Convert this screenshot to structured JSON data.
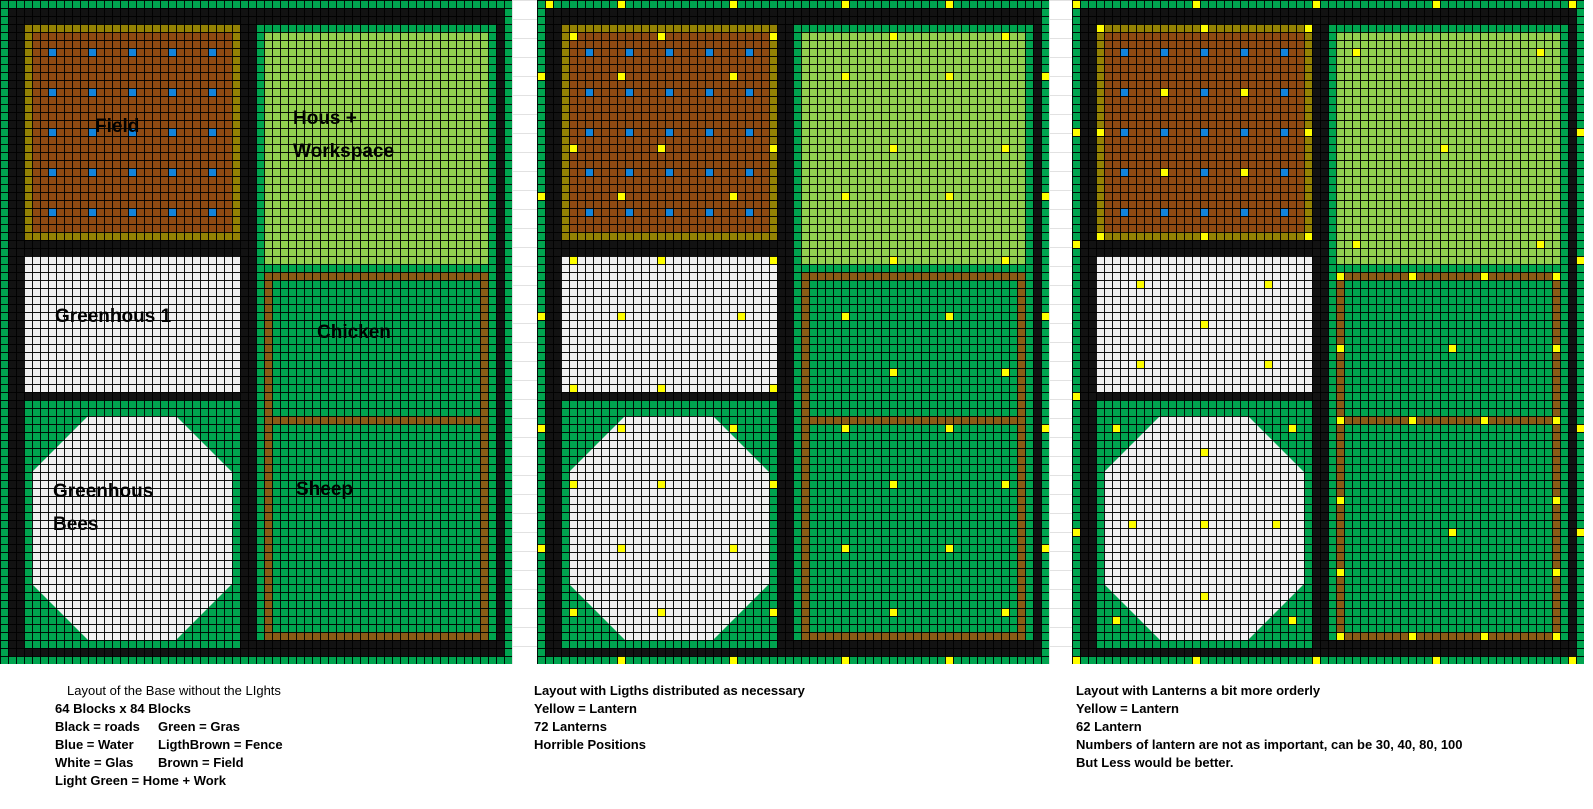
{
  "diagram_title": "Minecraft base layout plan (3 variants)",
  "grid": {
    "cell_px": 8,
    "cols": 64,
    "rows": 83,
    "octagon_cut_px": 56,
    "colors": {
      "road": "#121212",
      "grass": "#00a44f",
      "light_green": "#92d050",
      "glass_white": "#f0f0f0",
      "field_brown": "#8e4a12",
      "field_fence": "#948204",
      "pen_fence": "#8a5c16",
      "water_blue": "#1184dc",
      "lantern_yellow": "#ffff00",
      "grid_line": "#000000"
    },
    "regions": [
      {
        "name": "border-top",
        "c": 0,
        "r": 0,
        "w": 64,
        "h": 1,
        "color": "grass"
      },
      {
        "name": "border-bottom",
        "c": 0,
        "r": 82,
        "w": 64,
        "h": 1,
        "color": "grass"
      },
      {
        "name": "border-left",
        "c": 0,
        "r": 0,
        "w": 1,
        "h": 83,
        "color": "grass"
      },
      {
        "name": "border-right",
        "c": 63,
        "r": 0,
        "w": 1,
        "h": 83,
        "color": "grass"
      },
      {
        "name": "field-fence",
        "c": 3,
        "r": 3,
        "w": 27,
        "h": 27,
        "color": "field_fence"
      },
      {
        "name": "field-soil",
        "c": 4,
        "r": 4,
        "w": 25,
        "h": 25,
        "color": "field_brown"
      },
      {
        "name": "hous-grass-edge",
        "c": 32,
        "r": 3,
        "w": 30,
        "h": 31,
        "color": "grass"
      },
      {
        "name": "hous-floor",
        "c": 33,
        "r": 4,
        "w": 28,
        "h": 29,
        "color": "light_green"
      },
      {
        "name": "greenhous1-glass",
        "c": 3,
        "r": 32,
        "w": 27,
        "h": 17,
        "color": "glass_white"
      },
      {
        "name": "pen-grass",
        "c": 32,
        "r": 34,
        "w": 30,
        "h": 46,
        "color": "grass"
      },
      {
        "name": "pen-fence",
        "c": 33,
        "r": 34,
        "w": 28,
        "h": 46,
        "color": "pen_fence"
      },
      {
        "name": "pen-inner-grass",
        "c": 34,
        "r": 35,
        "w": 26,
        "h": 44,
        "color": "grass"
      },
      {
        "name": "pen-divider-fence",
        "c": 33,
        "r": 52,
        "w": 28,
        "h": 1,
        "color": "pen_fence"
      },
      {
        "name": "bees-grass",
        "c": 3,
        "r": 50,
        "w": 27,
        "h": 31,
        "color": "grass"
      },
      {
        "name": "bees-glass-octagon",
        "c": 4,
        "r": 52,
        "w": 25,
        "h": 28,
        "color": "glass_white",
        "octagon": true
      }
    ],
    "water": {
      "cols": [
        6,
        11,
        16,
        21,
        26
      ],
      "rows": [
        6,
        11,
        16,
        21,
        26
      ]
    }
  },
  "panels": [
    {
      "id": "base-without-lights",
      "title": "Layout of the Base without the LIghts",
      "caption_lines": [
        {
          "left": "64 Blocks x 84 Blocks",
          "right": ""
        },
        {
          "left": "Black = roads",
          "right": "Green = Gras"
        },
        {
          "left": "Blue = Water",
          "right": "LigthBrown = Fence"
        },
        {
          "left": "White = Glas",
          "right": "Brown = Field"
        },
        {
          "left": "Light Green = Home + Work",
          "right": ""
        }
      ],
      "labels": [
        {
          "text": "Field",
          "x": 95,
          "y": 116
        },
        {
          "text": "Hous +",
          "x": 293,
          "y": 108
        },
        {
          "text": "Workspace",
          "x": 293,
          "y": 141
        },
        {
          "text": "Greenhous 1",
          "x": 55,
          "y": 306
        },
        {
          "text": "Chicken",
          "x": 317,
          "y": 322
        },
        {
          "text": "Greenhous",
          "x": 53,
          "y": 481
        },
        {
          "text": "Bees",
          "x": 53,
          "y": 514
        },
        {
          "text": "Sheep",
          "x": 296,
          "y": 479
        }
      ],
      "lanterns": []
    },
    {
      "id": "lights-as-necessary",
      "title": "Layout with Ligths distributed as necessary",
      "caption_lines": [
        {
          "left": "Yellow = Lantern",
          "right": ""
        },
        {
          "left": "72 Lanterns",
          "right": ""
        },
        {
          "left": "Horrible Positions",
          "right": ""
        }
      ],
      "labels": [],
      "lanterns": [
        [
          1,
          0
        ],
        [
          10,
          0
        ],
        [
          24,
          0
        ],
        [
          38,
          0
        ],
        [
          51,
          0
        ],
        [
          10,
          82
        ],
        [
          24,
          82
        ],
        [
          38,
          82
        ],
        [
          51,
          82
        ],
        [
          0,
          9
        ],
        [
          0,
          24
        ],
        [
          0,
          39
        ],
        [
          0,
          53
        ],
        [
          0,
          68
        ],
        [
          63,
          9
        ],
        [
          63,
          24
        ],
        [
          63,
          39
        ],
        [
          63,
          53
        ],
        [
          63,
          68
        ],
        [
          4,
          4
        ],
        [
          15,
          4
        ],
        [
          29,
          4
        ],
        [
          44,
          4
        ],
        [
          58,
          4
        ],
        [
          10,
          9
        ],
        [
          24,
          9
        ],
        [
          38,
          9
        ],
        [
          51,
          9
        ],
        [
          4,
          18
        ],
        [
          15,
          18
        ],
        [
          29,
          18
        ],
        [
          44,
          18
        ],
        [
          58,
          18
        ],
        [
          10,
          24
        ],
        [
          24,
          24
        ],
        [
          38,
          24
        ],
        [
          51,
          24
        ],
        [
          4,
          32
        ],
        [
          15,
          32
        ],
        [
          29,
          32
        ],
        [
          44,
          32
        ],
        [
          58,
          32
        ],
        [
          10,
          39
        ],
        [
          25,
          39
        ],
        [
          38,
          39
        ],
        [
          51,
          39
        ],
        [
          4,
          48
        ],
        [
          15,
          48
        ],
        [
          29,
          48
        ],
        [
          44,
          46
        ],
        [
          58,
          46
        ],
        [
          10,
          53
        ],
        [
          24,
          53
        ],
        [
          38,
          53
        ],
        [
          51,
          53
        ],
        [
          4,
          60
        ],
        [
          15,
          60
        ],
        [
          29,
          60
        ],
        [
          44,
          60
        ],
        [
          58,
          60
        ],
        [
          10,
          68
        ],
        [
          24,
          68
        ],
        [
          38,
          68
        ],
        [
          51,
          68
        ],
        [
          4,
          76
        ],
        [
          15,
          76
        ],
        [
          29,
          76
        ],
        [
          44,
          76
        ],
        [
          58,
          76
        ]
      ]
    },
    {
      "id": "lanterns-more-orderly",
      "title": "Layout with Lanterns a bit more orderly",
      "caption_lines": [
        {
          "left": "Yellow = Lantern",
          "right": ""
        },
        {
          "left": "62 Lantern",
          "right": ""
        },
        {
          "left": "Numbers of lantern are not as important, can be 30, 40, 80, 100",
          "right": ""
        },
        {
          "left": "But Less would be better.",
          "right": ""
        }
      ],
      "labels": [],
      "lanterns": [
        [
          0,
          0
        ],
        [
          15,
          0
        ],
        [
          30,
          0
        ],
        [
          45,
          0
        ],
        [
          62,
          0
        ],
        [
          0,
          82
        ],
        [
          15,
          82
        ],
        [
          30,
          82
        ],
        [
          45,
          82
        ],
        [
          62,
          82
        ],
        [
          0,
          16
        ],
        [
          0,
          30
        ],
        [
          0,
          49
        ],
        [
          0,
          66
        ],
        [
          63,
          16
        ],
        [
          63,
          32
        ],
        [
          63,
          53
        ],
        [
          63,
          66
        ],
        [
          3,
          3
        ],
        [
          16,
          3
        ],
        [
          29,
          3
        ],
        [
          3,
          16
        ],
        [
          29,
          16
        ],
        [
          3,
          29
        ],
        [
          16,
          29
        ],
        [
          29,
          29
        ],
        [
          11,
          11
        ],
        [
          21,
          11
        ],
        [
          11,
          21
        ],
        [
          21,
          21
        ],
        [
          35,
          6
        ],
        [
          58,
          6
        ],
        [
          46,
          18
        ],
        [
          35,
          30
        ],
        [
          58,
          30
        ],
        [
          8,
          35
        ],
        [
          24,
          35
        ],
        [
          16,
          40
        ],
        [
          8,
          45
        ],
        [
          24,
          45
        ],
        [
          5,
          53
        ],
        [
          27,
          53
        ],
        [
          16,
          56
        ],
        [
          7,
          65
        ],
        [
          16,
          65
        ],
        [
          25,
          65
        ],
        [
          16,
          74
        ],
        [
          5,
          77
        ],
        [
          27,
          77
        ],
        [
          33,
          34
        ],
        [
          42,
          34
        ],
        [
          51,
          34
        ],
        [
          60,
          34
        ],
        [
          33,
          43
        ],
        [
          60,
          43
        ],
        [
          47,
          43
        ],
        [
          33,
          52
        ],
        [
          42,
          52
        ],
        [
          51,
          52
        ],
        [
          60,
          52
        ],
        [
          33,
          62
        ],
        [
          60,
          62
        ],
        [
          47,
          66
        ],
        [
          33,
          71
        ],
        [
          60,
          71
        ],
        [
          33,
          79
        ],
        [
          42,
          79
        ],
        [
          51,
          79
        ],
        [
          60,
          79
        ]
      ]
    }
  ]
}
